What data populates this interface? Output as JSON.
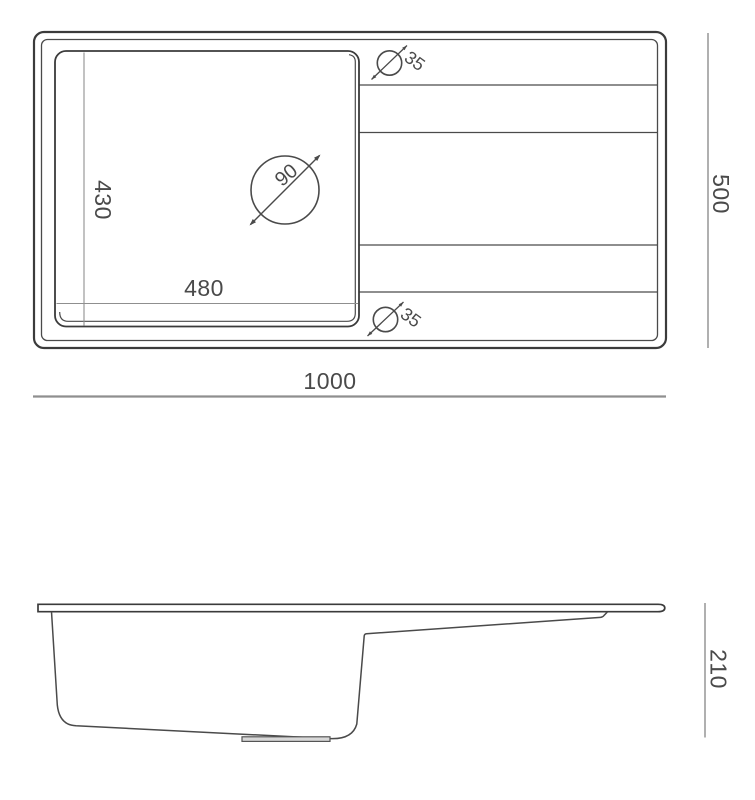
{
  "top_view": {
    "overall_width": "1000",
    "overall_depth": "500",
    "bowl_width": "480",
    "bowl_depth": "430",
    "drain_diameter": "90",
    "hole_top_diameter": "35",
    "hole_bottom_diameter": "35"
  },
  "side_view": {
    "overall_height": "210"
  },
  "colors": {
    "background": "#ffffff",
    "line": "#3b3b3b",
    "dim_line": "#8f8f8f",
    "text": "#4a4a4a"
  }
}
